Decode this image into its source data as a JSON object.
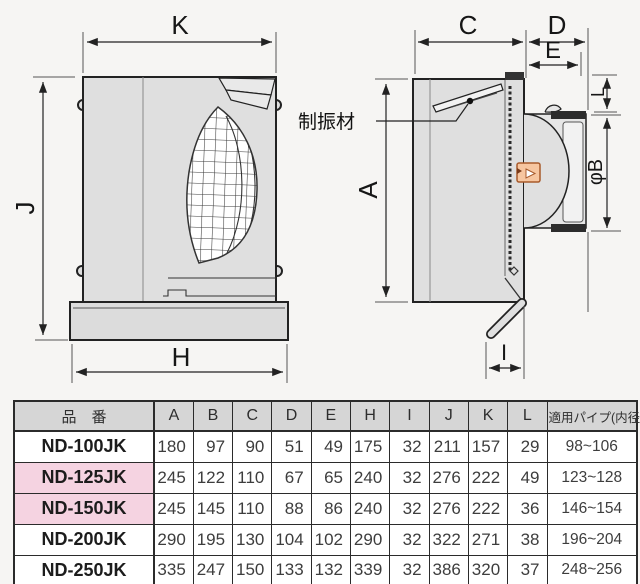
{
  "colors": {
    "page_bg": "#f6f5f3",
    "body_fill": "#dfdfdf",
    "flange_fill": "#dcdcdc",
    "line": "#222222",
    "sticker_fill": "#f7c6a0",
    "sticker_border": "#a85a2b",
    "header_bg": "#d6d6d6",
    "highlight_bg": "#f5d3e1",
    "table_border": "#2b2b2b",
    "cell_bg": "#ffffff"
  },
  "diagram": {
    "front_view": {
      "dims": {
        "k": "K",
        "j": "J",
        "h": "H"
      }
    },
    "side_view": {
      "dims": {
        "c": "C",
        "d": "D",
        "e": "E",
        "l": "L",
        "a": "A",
        "phi_b": "φB",
        "i": "I"
      },
      "callout": "制振材"
    }
  },
  "table": {
    "header": {
      "part_no": "品　番",
      "dims": [
        "A",
        "B",
        "C",
        "D",
        "E",
        "H",
        "I",
        "J",
        "K",
        "L"
      ],
      "pipe": "適用パイプ(内径)"
    },
    "rows": [
      {
        "model": "ND-100JK",
        "highlighted": false,
        "values": [
          "180",
          "97",
          "90",
          "51",
          "49",
          "175",
          "32",
          "211",
          "157",
          "29"
        ],
        "pipe_range": "98~106"
      },
      {
        "model": "ND-125JK",
        "highlighted": true,
        "values": [
          "245",
          "122",
          "110",
          "67",
          "65",
          "240",
          "32",
          "276",
          "222",
          "49"
        ],
        "pipe_range": "123~128"
      },
      {
        "model": "ND-150JK",
        "highlighted": true,
        "values": [
          "245",
          "145",
          "110",
          "88",
          "86",
          "240",
          "32",
          "276",
          "222",
          "36"
        ],
        "pipe_range": "146~154"
      },
      {
        "model": "ND-200JK",
        "highlighted": false,
        "values": [
          "290",
          "195",
          "130",
          "104",
          "102",
          "290",
          "32",
          "322",
          "271",
          "38"
        ],
        "pipe_range": "196~204"
      },
      {
        "model": "ND-250JK",
        "highlighted": false,
        "values": [
          "335",
          "247",
          "150",
          "133",
          "132",
          "339",
          "32",
          "386",
          "320",
          "37"
        ],
        "pipe_range": "248~256"
      }
    ]
  }
}
